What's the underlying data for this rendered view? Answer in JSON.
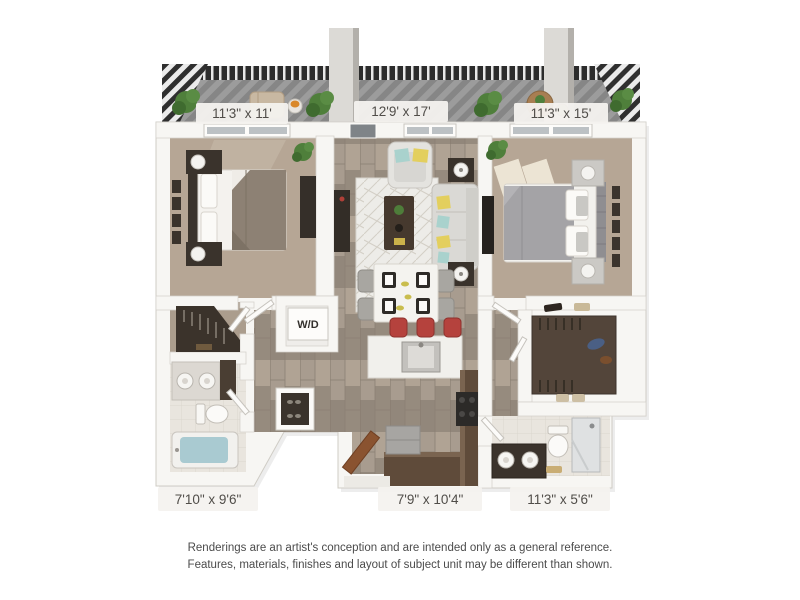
{
  "floor_plan": {
    "kind": "3d-floor-plan-rendering",
    "laundry_label": "W/D",
    "rooms": [
      {
        "id": "bedroom-left",
        "dimensions": "11'3\" x 11'"
      },
      {
        "id": "living-dining",
        "dimensions": "12'9' x 17'"
      },
      {
        "id": "bedroom-right",
        "dimensions": "11'3\" x 15'"
      },
      {
        "id": "bathroom-left",
        "dimensions": "7'10\" x 9'6\""
      },
      {
        "id": "kitchen-entry",
        "dimensions": "7'9\" x 10'4\""
      },
      {
        "id": "bathroom-right",
        "dimensions": "11'3\" x 5'6\""
      }
    ],
    "colors": {
      "wall": "#f7f6f3",
      "wall_line": "#cfccc5",
      "carpet": "#b6a695",
      "bath_tile": "#e9e5de",
      "railing": "#2c2c2c",
      "column": "#dedcd8",
      "plant": "#4f7f3b",
      "sofa": "#dad9d5",
      "pillow_yellow": "#e3cf5e",
      "pillow_teal": "#a9d2cd",
      "stool_red": "#b5423d",
      "cabinet_brown": "#5f4b3a",
      "entry_door_brown": "#8a5330",
      "tub_water": "#a9cad1",
      "closet_floor": "#53453a",
      "label_text": "#504d49"
    }
  },
  "disclaimer": {
    "line1": "Renderings are an artist's conception and are intended only as a general reference.",
    "line2": "Features, materials, finishes and layout of subject unit may be different than shown."
  }
}
